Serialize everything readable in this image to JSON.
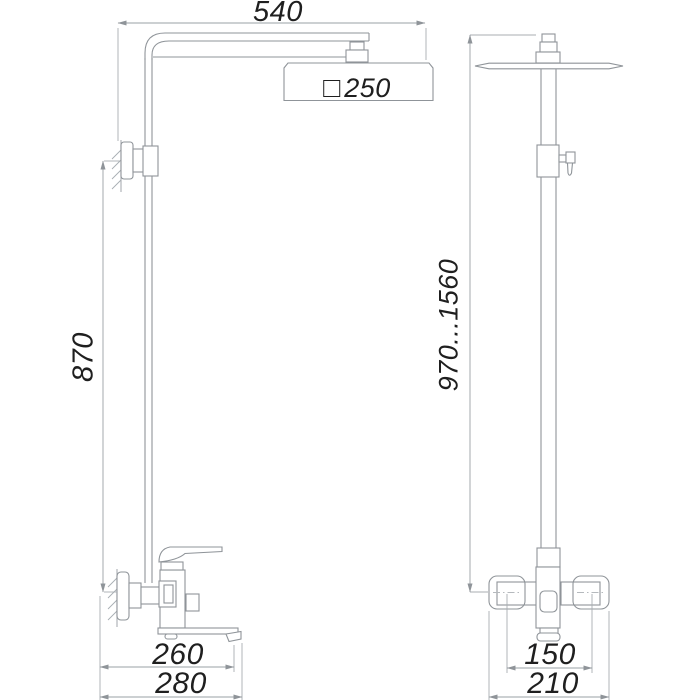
{
  "drawing": {
    "description": "shower-column-dimension-drawing",
    "colors": {
      "object_line": "#8f9499",
      "dimension_line": "#9aa0a5",
      "extension_line": "#a8adb2",
      "text": "#1f1f1f",
      "background": "#ffffff"
    },
    "front_view": {
      "dimensions": {
        "top_width": "540",
        "head_size": "250",
        "head_size_symbol": "□",
        "wall_to_mixer_height": "870",
        "spout_reach": "260",
        "overall_depth": "280"
      }
    },
    "side_view": {
      "dimensions": {
        "height_range": "970...1560",
        "centers_distance": "150",
        "mixer_width": "210"
      }
    }
  }
}
